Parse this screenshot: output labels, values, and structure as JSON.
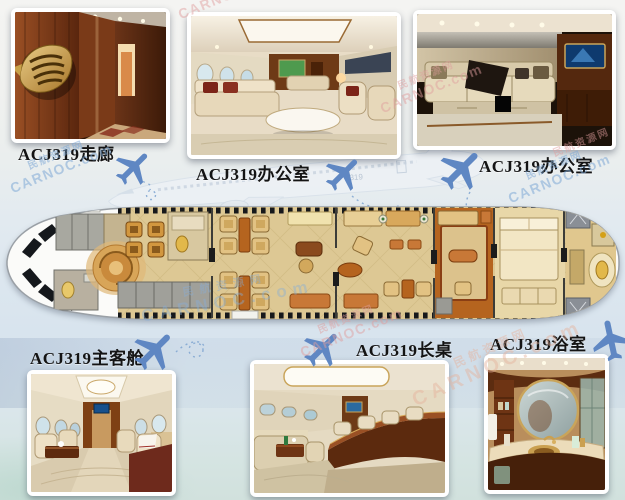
{
  "photos": [
    {
      "id": "corridor",
      "label": "ACJ319走廊",
      "depicts": "wood-paneled corridor with golden wing emblem"
    },
    {
      "id": "office-1",
      "label": "ACJ319办公室",
      "depicts": "lounge office with cream sofas and burl-wood bulkhead"
    },
    {
      "id": "office-2",
      "label": "ACJ319办公室",
      "depicts": "office lounge with long cream sofa and wall TV"
    },
    {
      "id": "main-cabin",
      "label": "ACJ319主客舱",
      "depicts": "main passenger cabin with leather club chairs"
    },
    {
      "id": "long-table",
      "label": "ACJ319长桌",
      "depicts": "cabin with long curved wooden table"
    },
    {
      "id": "bathroom",
      "label": "ACJ319浴室",
      "depicts": "bathroom with round mirror and gold sink"
    }
  ],
  "watermark": {
    "line1": "民航资源网",
    "line2": "CARNOC.com"
  },
  "background_plane": {
    "code": "319"
  },
  "floorplan": {
    "aircraft": "ACJ319 cabin top view"
  },
  "colors": {
    "plane_icon": "#5f87c3",
    "watermark_blue": "#7fa9d6",
    "watermark_red": "#e09e9e",
    "label_text": "#141414",
    "floor_tan": "#ddc894",
    "table_orange": "#b5641f",
    "galley_gray": "#a0a09a"
  }
}
